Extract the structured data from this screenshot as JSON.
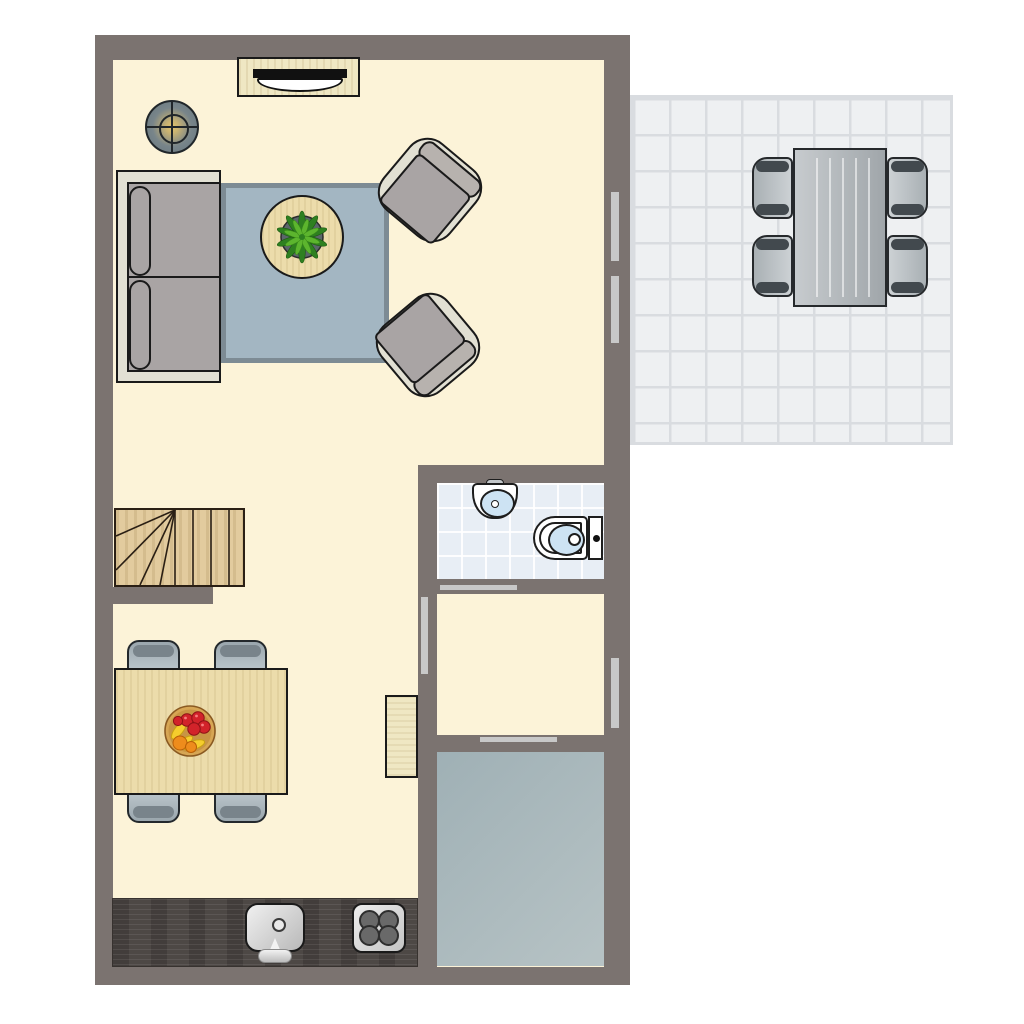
{
  "title": "Apartment ground floor plan, top-down view",
  "colors": {
    "page-bg": "#ffffff",
    "wall": "#7b7370",
    "floor": "#fcf3d8",
    "terrace-tile": "#eef0f2",
    "terrace-grid": "#d9dce0",
    "bath-tile": "#e8eef5",
    "basin": "#cde3f3",
    "gray-room-a": "#9fb0b5",
    "gray-room-b": "#b7c3c5",
    "rug": "#a3b6c2",
    "rug-border": "#7d8b94",
    "frame": "#e2e0d3",
    "cushion": "#a9a4a4",
    "pillow": "#b7b2ae",
    "wood": "#ecdcab",
    "wood-pale": "#efe7c3",
    "stairs-wood": "#e2cb9e",
    "counter": "#4d4845",
    "chair-blue": "#c6d0d5",
    "chair-blue-d": "#9aa6ad",
    "chair-cap": "#79848b",
    "table-gray-a": "#c7cbce",
    "table-gray-b": "#a0a6aa",
    "marker": "#c8c8c8",
    "lamp-ring": "#66757d",
    "lamp-center": "#e2c46c",
    "plant-dark": "#2e8020",
    "plant-light": "#5cb52e"
  },
  "rooms": {
    "living_area": {
      "label": "Open living and dining area"
    },
    "bathroom": {
      "label": "Bathroom with sink and toilet"
    },
    "hallway": {
      "label": "Hallway"
    },
    "storage": {
      "label": "Entrance / storage room with gray floor"
    },
    "terrace": {
      "label": "Tiled terrace"
    },
    "stairs": {
      "label": "Winder staircase"
    },
    "kitchen": {
      "label": "Kitchen counter along bottom wall"
    }
  },
  "furniture": {
    "sofa": {
      "label": "Two-seat sofa",
      "seats": 2
    },
    "armchairs": {
      "label": "Armchair",
      "count": 2
    },
    "coffee_table": {
      "label": "Round coffee table with plant"
    },
    "rug": {
      "label": "Blue-gray rug"
    },
    "tv_cabinet": {
      "label": "TV cabinet with television"
    },
    "lamp": {
      "label": "Floor lamp"
    },
    "dining_table": {
      "label": "Wooden dining table with fruit bowl",
      "chairs": 4
    },
    "sideboard": {
      "label": "Small wooden sideboard"
    },
    "kitchen_sink": {
      "label": "Kitchen sink with faucet"
    },
    "stove": {
      "label": "Cooktop",
      "burners": 4
    },
    "bath_sink": {
      "label": "Washbasin"
    },
    "toilet": {
      "label": "Toilet with cistern"
    },
    "terrace_table": {
      "label": "Terrace dining table",
      "chairs": 4
    }
  },
  "openings": {
    "living_window_upper": {
      "label": "Window, living room east wall"
    },
    "living_window_lower": {
      "label": "Window, living room east wall"
    },
    "hall_window": {
      "label": "Window, hallway east wall"
    },
    "bath_door": {
      "label": "Bathroom door"
    },
    "hall_door_west": {
      "label": "Door between living area and hallway"
    },
    "hall_door_south": {
      "label": "Door between hallway and storage room"
    }
  }
}
